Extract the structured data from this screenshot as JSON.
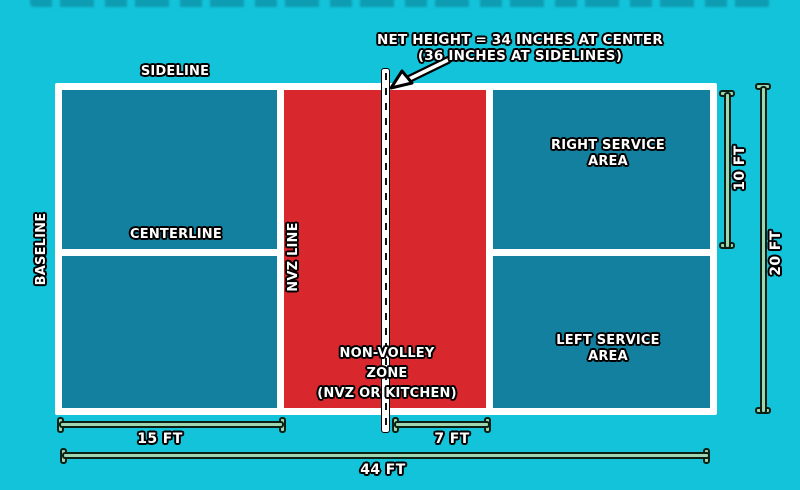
{
  "annotation": {
    "net_height_line1": "NET HEIGHT = 34 INCHES AT CENTER",
    "net_height_line2": "(36 INCHES AT SIDELINES)"
  },
  "labels": {
    "sideline": "SIDELINE",
    "baseline": "BASELINE",
    "centerline": "CENTERLINE",
    "nvz_line": "NVZ LINE",
    "right_service_line1": "RIGHT SERVICE",
    "right_service_line2": "AREA",
    "left_service_line1": "LEFT SERVICE",
    "left_service_line2": "AREA",
    "nvz_zone_line1": "NON-VOLLEY",
    "nvz_zone_line2": "ZONE",
    "nvz_zone_line3": "(NVZ OR KITCHEN)"
  },
  "measurements": {
    "service_area_length": "15 FT",
    "nvz_length": "7 FT",
    "court_length": "44 FT",
    "service_area_width": "10 FT",
    "court_width": "20 FT"
  },
  "colors": {
    "background": "#13c3da",
    "court_fill": "#14809f",
    "nvz_fill": "#d9272e",
    "court_lines": "#ffffff",
    "ruler_fill": "#9fd6b2",
    "ruler_outline": "#0c2014",
    "label_text": "#ffffff",
    "label_outline": "#000000"
  }
}
